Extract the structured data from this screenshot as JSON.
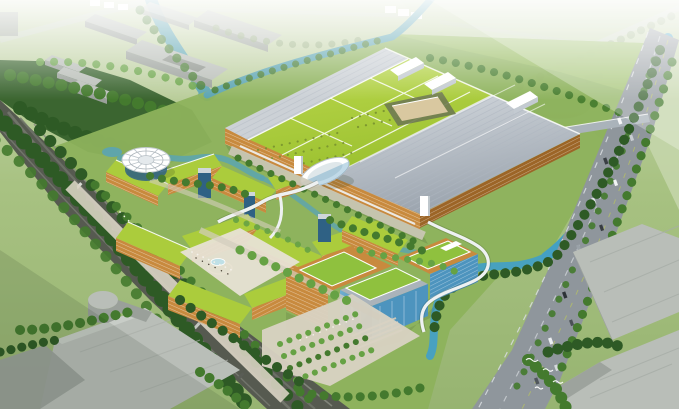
{
  "meta": {
    "type": "architectural-aerial-rendering",
    "description": "Bird's-eye architectural rendering of a green eco industrial campus: a huge factory with a lime-green planted roof and ribbed grey roof halls, zig-zag terraced office buildings with planted sloping roofs and orange louvered facades, a white circular pavilion, a blue glass office block, winding teal canals, tree-lined expressway and arterial road, and hazy grey context warehouses around the site.",
    "image_width_px": 679,
    "image_height_px": 409
  },
  "palette": {
    "grassFar": "#c6d6ac",
    "grassMid": "#a3bf7d",
    "grassCampus": "#8db25c",
    "grassBright": "#9fc26a",
    "forest": "#2e5a25",
    "tree": "#447a2e",
    "treeLight": "#66a244",
    "treeHazy": "#90a878",
    "canal": "#5ba4b2",
    "canalBright": "#44a0c4",
    "waterLight": "#7cc0cf",
    "roadDark": "#565a50",
    "roadLane": "#71756a",
    "roadGray": "#8f969c",
    "laneLine": "#d6dade",
    "pavement": "#d9d3c3",
    "pavementLight": "#e7e2d4",
    "contextTop": "#b9beb8",
    "contextSide": "#9aa09a",
    "contextDark": "#82887f",
    "factoryGreen": "#abcc3c",
    "factoryGreenHi": "#c0da52",
    "ribbed": "#c9ced4",
    "ribbedShade": "#a8b0ba",
    "orange": "#c88a3e",
    "orangeHi": "#e6ad60",
    "orangeDark": "#9c6527",
    "glass": "#4d94be",
    "glassDark": "#2f6184",
    "white": "#ffffff",
    "offWhite": "#eef1f2",
    "steel": "#aab3ba",
    "discEdge": "#b8c1c7",
    "shadow": "#223318",
    "haze": "#f2f5ee",
    "tan": "#d9c8a0"
  },
  "scene": {
    "features": [
      "large factory hall with lime-green planted roof, white roof grid, skylight dot rows and inner courtyard",
      "ribbed grey production halls with white rooftop sheds",
      "orange louvered factory facades with white oval entrance pavilion",
      "zig-zag terraced office bars with planted green roofs and glass towers",
      "white circular pavilion with radial ribbed disc roof",
      "blue glass office block with roof gardens, entry steps and tree-grid plaza",
      "teal canal loop with planted banks and small bridges",
      "elevated dark expressway lined with dense trees (lower left)",
      "grey arterial road with lane dashes, median trees and cars (right)",
      "hazy grey context warehouses (top and bottom corners)",
      "pedestrian promenade, fountains and people dots",
      "flock of white birds over trees (bottom right)",
      "atmospheric white haze toward the horizon"
    ],
    "counts": {
      "birds": 4,
      "road_vehicles": 13,
      "context_buildings_top": 9,
      "context_buildings_bottom": 5
    }
  }
}
